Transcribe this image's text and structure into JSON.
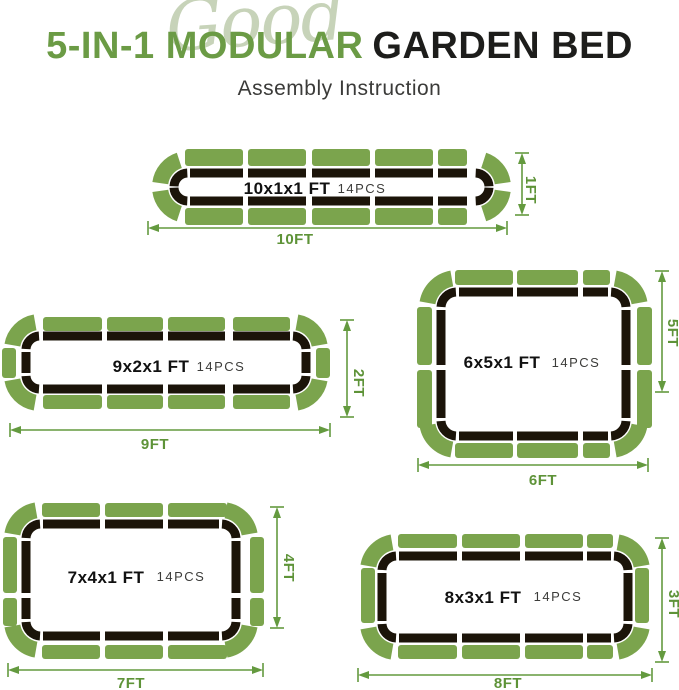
{
  "title": {
    "script_word": "Good",
    "green_part": "5-IN-1 MODULAR",
    "black_part": "GARDEN BED",
    "subtitle": "Assembly Instruction"
  },
  "colors": {
    "panel_green": "#7ba44d",
    "outline_black": "#1b1409",
    "dimension_green": "#649a3f",
    "title_green": "#6b9b45",
    "title_black": "#1d1d1b",
    "script_green": "#c7d3b9",
    "background": "#ffffff"
  },
  "beds": [
    {
      "size_label": "10x1x1 FT",
      "pieces_label": "14PCS",
      "length_label": "10FT",
      "width_label": "1FT",
      "panel_layout": {
        "top": 5,
        "bottom": 5,
        "left": 0,
        "right": 0,
        "corners": 4
      }
    },
    {
      "size_label": "9x2x1 FT",
      "pieces_label": "14PCS",
      "length_label": "9FT",
      "width_label": "2FT",
      "panel_layout": {
        "top": 4,
        "bottom": 4,
        "left": 1,
        "right": 1,
        "corners": 4
      }
    },
    {
      "size_label": "6x5x1 FT",
      "pieces_label": "14PCS",
      "length_label": "6FT",
      "width_label": "5FT",
      "panel_layout": {
        "top": 3,
        "bottom": 3,
        "left": 2,
        "right": 2,
        "corners": 4
      }
    },
    {
      "size_label": "7x4x1 FT",
      "pieces_label": "14PCS",
      "length_label": "7FT",
      "width_label": "4FT",
      "panel_layout": {
        "top": 3,
        "bottom": 3,
        "left": 2,
        "right": 2,
        "corners": 4
      }
    },
    {
      "size_label": "8x3x1 FT",
      "pieces_label": "14PCS",
      "length_label": "8FT",
      "width_label": "3FT",
      "panel_layout": {
        "top": 4,
        "bottom": 4,
        "left": 1,
        "right": 1,
        "corners": 4
      }
    }
  ]
}
